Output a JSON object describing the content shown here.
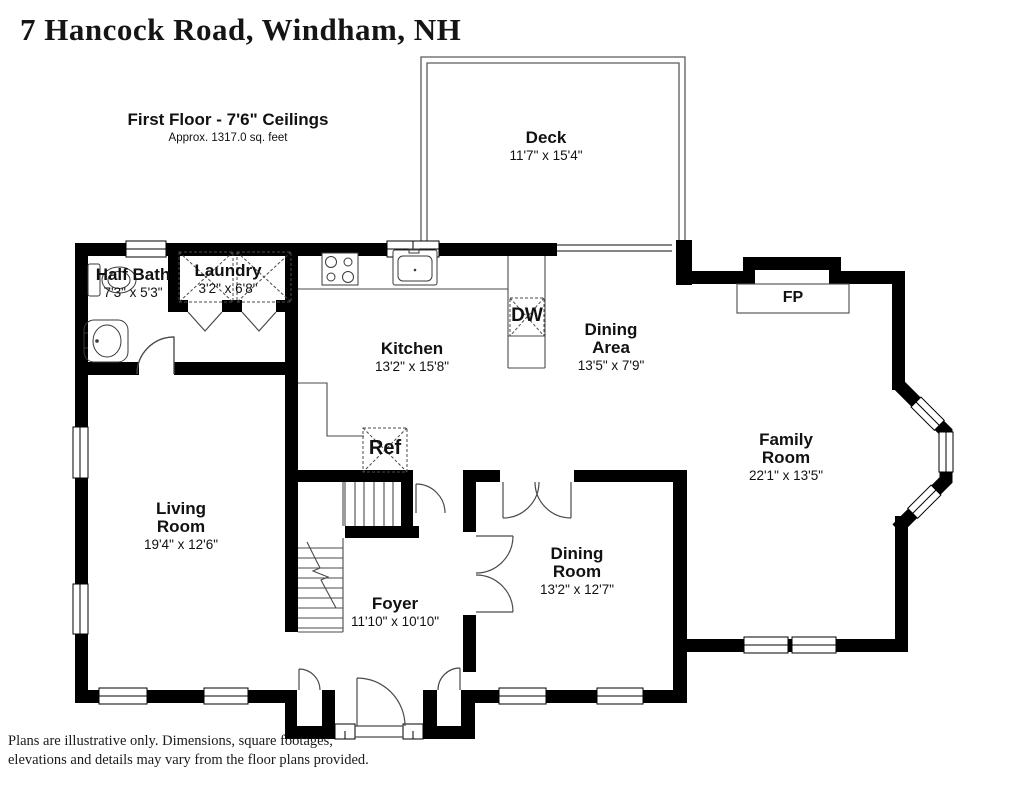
{
  "title": "7 Hancock Road, Windham, NH",
  "floor_header": {
    "title": "First Floor - 7'6\" Ceilings",
    "subtitle": "Approx. 1317.0 sq. feet"
  },
  "rooms": {
    "deck": {
      "name": "Deck",
      "dims": "11'7\" x 15'4\""
    },
    "laundry": {
      "name": "Laundry",
      "dims": "3'2\" x 6'8\""
    },
    "half_bath": {
      "name": "Half Bath",
      "dims": "7'3\" x 5'3\""
    },
    "kitchen": {
      "name": "Kitchen",
      "dims": "13'2\" x 15'8\""
    },
    "dining_area": {
      "name": "Dining Area",
      "dims": "13'5\" x 7'9\""
    },
    "family_room": {
      "name": "Family Room",
      "dims": "22'1\" x 13'5\""
    },
    "living_room": {
      "name": "Living Room",
      "dims": "19'4\" x 12'6\""
    },
    "dining_room": {
      "name": "Dining Room",
      "dims": "13'2\" x 12'7\""
    },
    "foyer": {
      "name": "Foyer",
      "dims": "11'10\" x 10'10\""
    }
  },
  "fixtures": {
    "dishwasher": "DW",
    "refrigerator": "Ref",
    "fireplace": "FP"
  },
  "disclaimer": [
    "Plans are illustrative only. Dimensions, square footages,",
    "elevations and details may vary from the floor plans provided."
  ],
  "colors": {
    "wall": "#000000",
    "thin_line": "#4a4a4a",
    "text": "#111111"
  }
}
